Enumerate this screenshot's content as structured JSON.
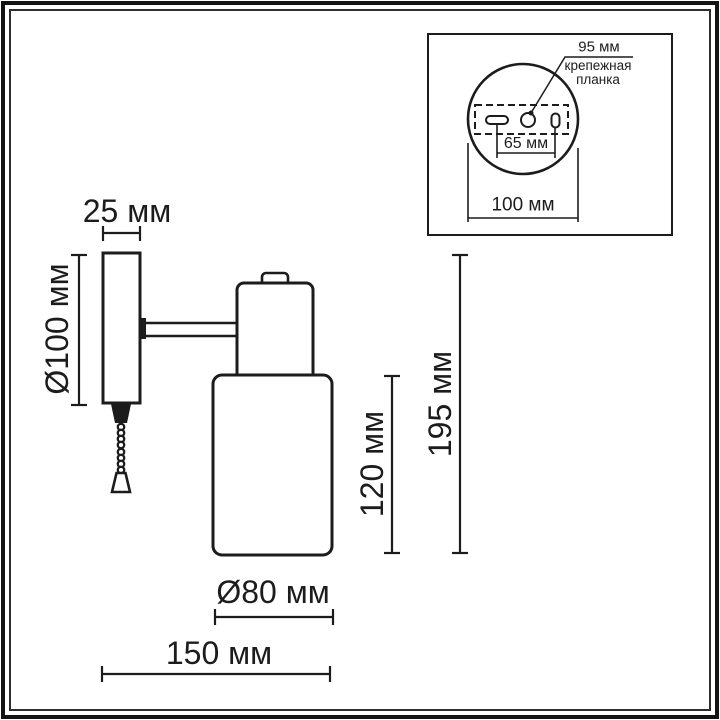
{
  "drawing_type": "wall-sconce dimension drawing",
  "colors": {
    "line": "#1c1c1c",
    "background": "#ffffff"
  },
  "main_view": {
    "dim_plate_width": "25 мм",
    "dim_plate_diameter": "Ø100 мм",
    "dim_shade_height": "120 мм",
    "dim_total_height": "195 мм",
    "dim_shade_diameter": "Ø80 мм",
    "dim_total_depth": "150 мм"
  },
  "inset_view": {
    "dim_plate_length": "95 мм",
    "label_mounting_line1": "крепежная",
    "label_mounting_line2": "планка",
    "dim_hole_spacing": "65 мм",
    "dim_plate_overall": "100 мм"
  }
}
